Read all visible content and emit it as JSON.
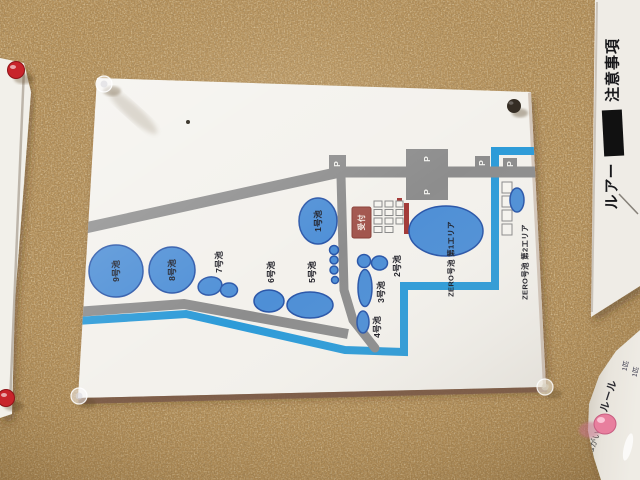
{
  "board": {
    "cork_color": "#b28e58"
  },
  "map_sign": {
    "ponds": [
      {
        "name": "pond-9",
        "label": "9号池"
      },
      {
        "name": "pond-8",
        "label": "8号池"
      },
      {
        "name": "pond-7",
        "label": "7号池"
      },
      {
        "name": "pond-6",
        "label": "6号池"
      },
      {
        "name": "pond-5",
        "label": "5号池"
      },
      {
        "name": "pond-4",
        "label": "4号池"
      },
      {
        "name": "pond-3",
        "label": "3号池"
      },
      {
        "name": "pond-2",
        "label": "2号池"
      },
      {
        "name": "pond-1",
        "label": "1号池"
      }
    ],
    "zero_area_1_label": "ZERO号池 第1エリア",
    "zero_area_2_label": "ZERO号池 第2エリア",
    "reception_label": "受付",
    "parking_label": "P",
    "colors": {
      "paper": "#f3f1ec",
      "pond_fill": "#4e8fd6",
      "pond_stroke": "#2a56a8",
      "road_gray": "#8d8d8d",
      "river_blue": "#2d9bd8",
      "reception_red": "#a2564e",
      "accent_red": "#a33a38"
    }
  },
  "right_sign": {
    "line_start": "ルアー",
    "line_end": "注意事項"
  },
  "rules_sheet": {
    "title": "ルール",
    "small_note_1": "1匹",
    "small_note_2": "1匹",
    "side_text": "おねがい"
  }
}
